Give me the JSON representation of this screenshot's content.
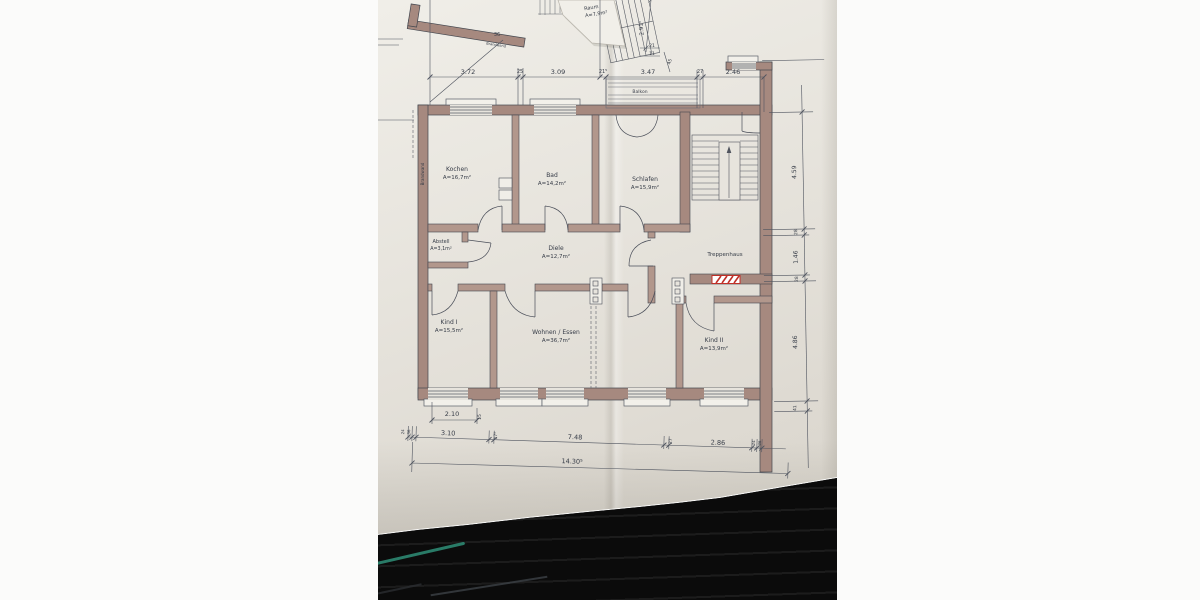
{
  "colors": {
    "paper": "#e7e4dd",
    "wall_fill": "#a6897f",
    "wall_fill_light": "#b2978c",
    "ink_line": "#4a4e59",
    "ink_text": "#363c47",
    "accent_red": "#c03028",
    "dark_surface": "#0b0b0b",
    "teal_reflection": "#2f8f78"
  },
  "plan": {
    "rooms": {
      "kochen": {
        "name": "Kochen",
        "area": "A=16,7m²"
      },
      "bad": {
        "name": "Bad",
        "area": "A=14,2m²"
      },
      "schlafen": {
        "name": "Schlafen",
        "area": "A=15,9m²"
      },
      "abstell": {
        "name": "Abstell",
        "area": "A=3,1m²"
      },
      "diele": {
        "name": "Diele",
        "area": "A=12,7m²"
      },
      "treppenhaus": {
        "name": "Treppenhaus"
      },
      "kind1": {
        "name": "Kind I",
        "area": "A=15,5m²"
      },
      "wohnen_essen": {
        "name": "Wohnen / Essen",
        "area": "A=36,7m²"
      },
      "kind2": {
        "name": "Kind II",
        "area": "A=13,9m²"
      },
      "balkon": {
        "name": "Balkon"
      },
      "raum": {
        "name": "Raum",
        "area": "A=7,9m²"
      }
    },
    "wall_labels": {
      "brandwand_left": "Brandwand",
      "brandwand_top": "Brandwand"
    },
    "dims": {
      "top": {
        "d1": "3.72",
        "t1": "25",
        "d2": "3.09",
        "t2": "21⁵",
        "d3": "3.47",
        "t3": "27",
        "d4": "2.46"
      },
      "upper": {
        "v": "2.91⁵",
        "s1": "21",
        "s2": "11",
        "s3": "45",
        "w": "36"
      },
      "bottom": {
        "b1": "2.10",
        "b1s": "15",
        "b2": "3.10",
        "b2s": "17⁵",
        "b3": "7.48",
        "b3s": "27",
        "b4": "2.86",
        "total": "14.30⁵",
        "left_s1": "24",
        "left_s2": "36",
        "right_s1": "24",
        "right_s2": "36"
      },
      "right": {
        "r1": "4.59",
        "r1s": "28",
        "r2": "1.46",
        "r2s": "28",
        "r3": "4.86",
        "r3s": "41"
      }
    }
  }
}
